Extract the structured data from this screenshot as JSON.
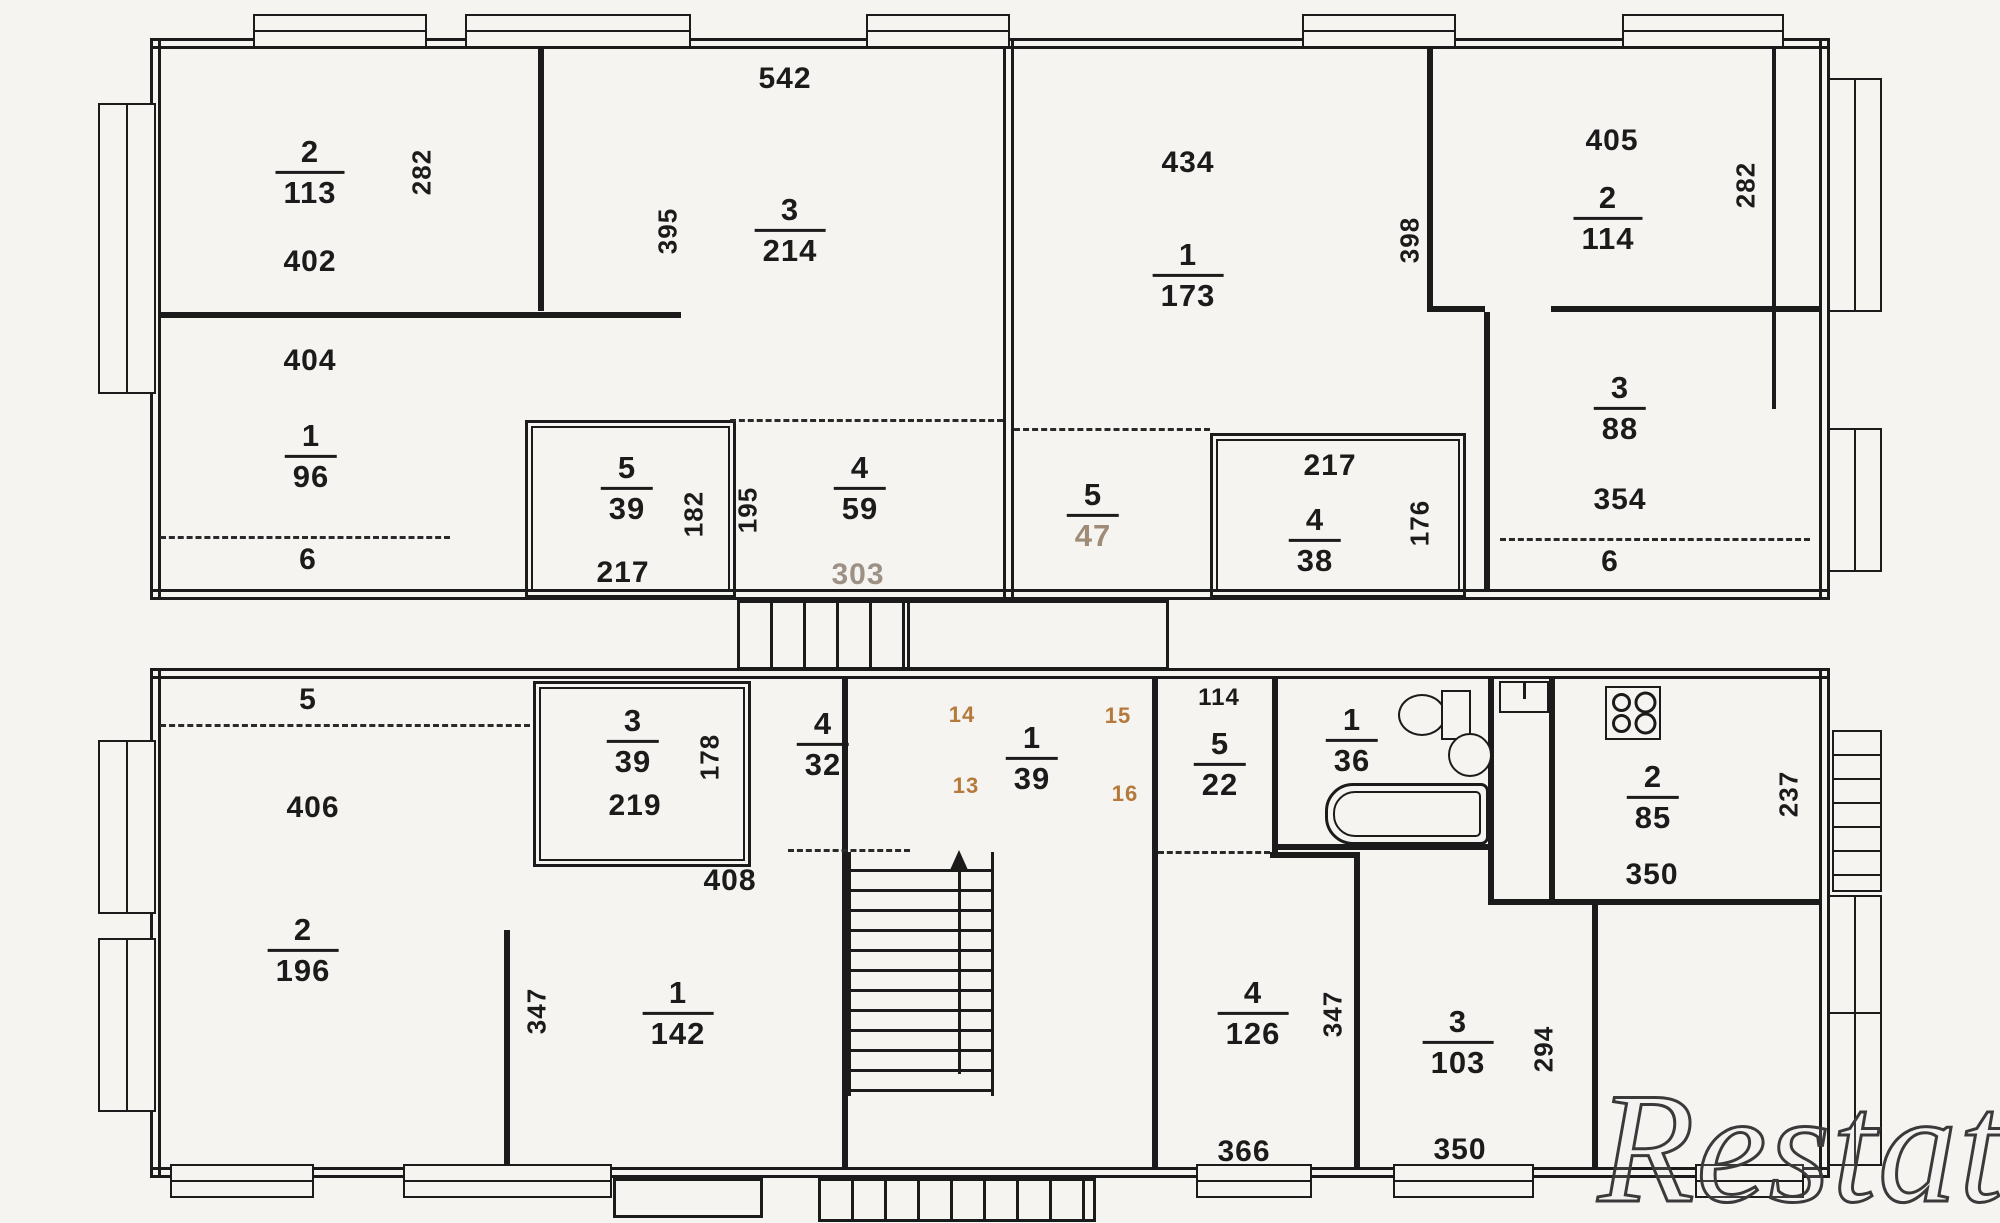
{
  "watermark": "Restate",
  "accent_color": "#b5793c",
  "upper": {
    "left": {
      "room2": {
        "num": "2",
        "area": "113"
      },
      "dim282": "282",
      "dim402": "402",
      "dim404": "404",
      "room1": {
        "num": "1",
        "area": "96"
      },
      "dim6": "6",
      "dim542": "542",
      "dim395": "395",
      "room3": {
        "num": "3",
        "area": "214"
      },
      "closet5": {
        "num": "5",
        "area": "39"
      },
      "dim182": "182",
      "dim195": "195",
      "dim217": "217",
      "hall4": {
        "num": "4",
        "area": "59"
      },
      "dim303": "303"
    },
    "right": {
      "dim434": "434",
      "room1": {
        "num": "1",
        "area": "173"
      },
      "dim398": "398",
      "hall5": {
        "num": "5",
        "area": "47"
      },
      "dim217": "217",
      "closet4": {
        "num": "4",
        "area": "38"
      },
      "dim176": "176",
      "dim405": "405",
      "room2": {
        "num": "2",
        "area": "114"
      },
      "dim282": "282",
      "room3": {
        "num": "3",
        "area": "88"
      },
      "dim354": "354",
      "dim6": "6"
    }
  },
  "lower": {
    "left": {
      "dim5": "5",
      "dim406": "406",
      "room2": {
        "num": "2",
        "area": "196"
      },
      "dim347": "347",
      "closet3": {
        "num": "3",
        "area": "39"
      },
      "dim219": "219",
      "dim178": "178",
      "hall4": {
        "num": "4",
        "area": "32"
      },
      "dim408": "408",
      "room1": {
        "num": "1",
        "area": "142"
      }
    },
    "center": {
      "hall1": {
        "num": "1",
        "area": "39"
      },
      "marks": {
        "tl": "14",
        "tr": "15",
        "bl": "13",
        "br": "16"
      },
      "dim114": "114",
      "hall5": {
        "num": "5",
        "area": "22"
      }
    },
    "right": {
      "bath1": {
        "num": "1",
        "area": "36"
      },
      "kitchen2": {
        "num": "2",
        "area": "85"
      },
      "dim350k": "350",
      "dim237": "237",
      "room4": {
        "num": "4",
        "area": "126"
      },
      "dim366": "366",
      "dim347": "347",
      "room3": {
        "num": "3",
        "area": "103"
      },
      "dim350": "350",
      "dim294": "294"
    }
  }
}
